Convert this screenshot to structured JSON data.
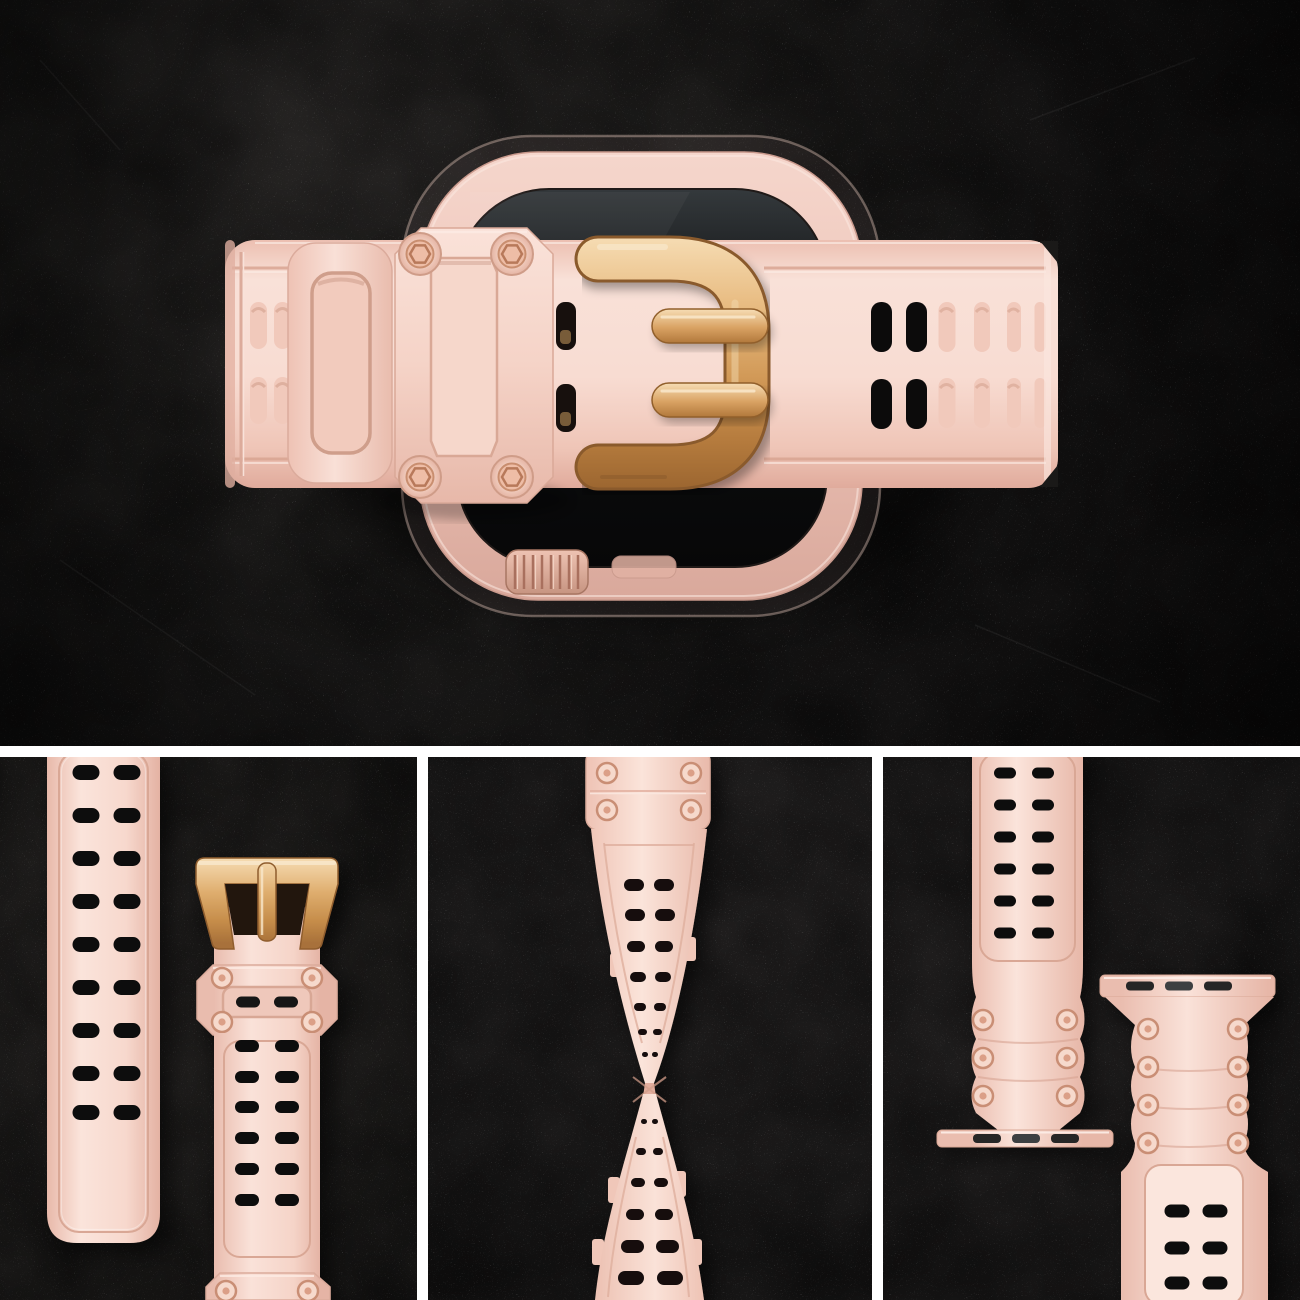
{
  "meta": {
    "type": "product-photo-collage",
    "subject": "Pink rugged silicone sport watch band with rose-gold buckle on a pink smartwatch, dark stone background, four-panel collage"
  },
  "colors": {
    "background": "#171717",
    "divider": "#ffffff",
    "band-pink": "#f7d8cd",
    "band-highlight": "#fbe6dd",
    "band-shadow": "#e6b5a6",
    "metal-gold-light": "#f6dcb3",
    "metal-gold": "#d9a263",
    "metal-gold-dark": "#9c6630",
    "watch-case": "#eec9bd",
    "screen-black": "#0c0d0e",
    "hole-black": "#0f0d0d",
    "rivet-ring": "#cf9478"
  },
  "panels": {
    "hero": {
      "label": "Top view: watch with rugged pink band fastened across the case, rose-gold pin buckle and armored keeper frame with four screws"
    },
    "detail_strap": {
      "label": "Close-up: perforated strap tail beside buckle strap with armored keeper and screw rivets"
    },
    "detail_flex": {
      "label": "Close-up: strap twisted 180 degrees to show flexibility, riveted header at top"
    },
    "detail_connectors": {
      "label": "Close-up: two band halves with watch-lug connectors and riveted ribbed sections"
    }
  }
}
